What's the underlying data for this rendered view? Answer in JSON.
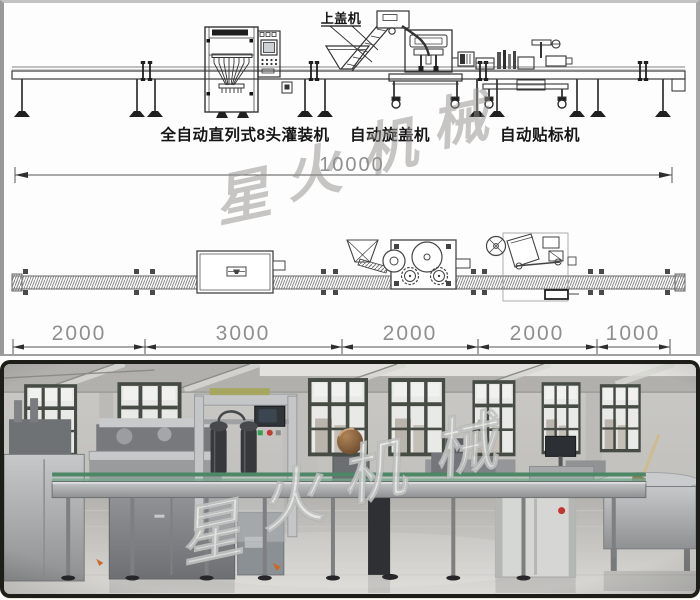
{
  "diagram": {
    "machine_labels": {
      "cap_feeder": "上盖机",
      "filling_machine": "全自动直列式8头灌装机",
      "capping_machine": "自动旋盖机",
      "labeling_machine": "自动贴标机"
    },
    "dimensions": {
      "total_length_mm": "10000",
      "segments_mm": [
        "2000",
        "3000",
        "2000",
        "2000",
        "1000"
      ]
    },
    "watermark_chars": [
      "星",
      "火",
      "机",
      "械"
    ]
  },
  "photo": {
    "watermark_chars": [
      "星",
      "火",
      "机",
      "械"
    ]
  },
  "colors": {
    "drawing_line": "#3a3a3a",
    "dimension_text": "#8f8f8f",
    "machine_label_text": "#151515",
    "watermark_grey": "#8f8d8b",
    "watermark_white": "#eef0ee",
    "photo_frame": "#1e1e18",
    "conveyor_guard_green": "#4d8766",
    "hmi_screen_dark": "#2c3034",
    "emergency_button_red": "#c4342e",
    "cap_sorter_brown": "#8a6648"
  }
}
